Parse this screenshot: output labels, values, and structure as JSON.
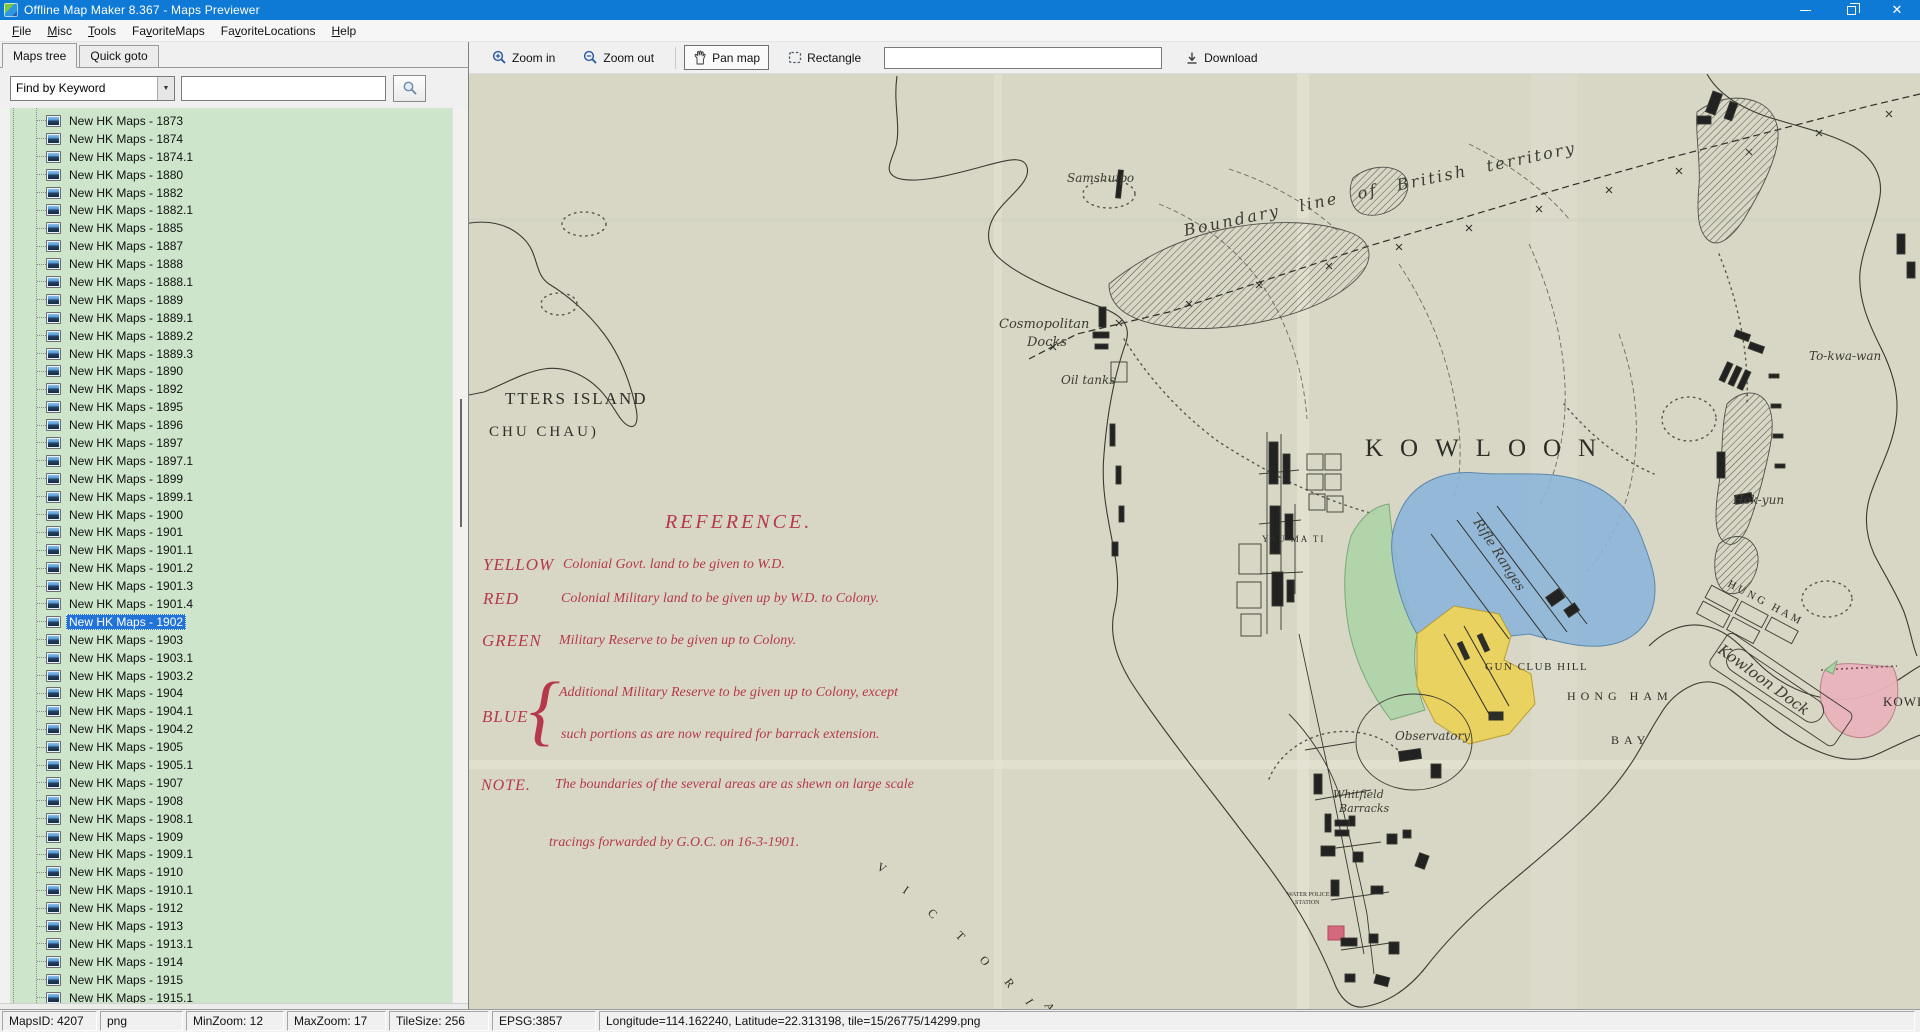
{
  "window": {
    "title": "Offline Map Maker 8.367 - Maps Previewer"
  },
  "menu": {
    "items": [
      {
        "label": "File",
        "accel": 0
      },
      {
        "label": "Misc",
        "accel": 0
      },
      {
        "label": "Tools",
        "accel": 0
      },
      {
        "label": "FavoriteMaps",
        "accel": 2
      },
      {
        "label": "FavoriteLocations",
        "accel": 2
      },
      {
        "label": "Help",
        "accel": 0
      }
    ]
  },
  "left_panel": {
    "tabs": [
      {
        "label": "Maps tree"
      },
      {
        "label": "Quick goto"
      }
    ],
    "search": {
      "combo_value": "Find by Keyword",
      "query_value": ""
    },
    "tree": {
      "selected_index": 28,
      "items": [
        "New HK Maps - 1873",
        "New HK Maps - 1874",
        "New HK Maps - 1874.1",
        "New HK Maps - 1880",
        "New HK Maps - 1882",
        "New HK Maps - 1882.1",
        "New HK Maps - 1885",
        "New HK Maps - 1887",
        "New HK Maps - 1888",
        "New HK Maps - 1888.1",
        "New HK Maps - 1889",
        "New HK Maps - 1889.1",
        "New HK Maps - 1889.2",
        "New HK Maps - 1889.3",
        "New HK Maps - 1890",
        "New HK Maps - 1892",
        "New HK Maps - 1895",
        "New HK Maps - 1896",
        "New HK Maps - 1897",
        "New HK Maps - 1897.1",
        "New HK Maps - 1899",
        "New HK Maps - 1899.1",
        "New HK Maps - 1900",
        "New HK Maps - 1901",
        "New HK Maps - 1901.1",
        "New HK Maps - 1901.2",
        "New HK Maps - 1901.3",
        "New HK Maps - 1901.4",
        "New HK Maps - 1902",
        "New HK Maps - 1903",
        "New HK Maps - 1903.1",
        "New HK Maps - 1903.2",
        "New HK Maps - 1904",
        "New HK Maps - 1904.1",
        "New HK Maps - 1904.2",
        "New HK Maps - 1905",
        "New HK Maps - 1905.1",
        "New HK Maps - 1907",
        "New HK Maps - 1908",
        "New HK Maps - 1908.1",
        "New HK Maps - 1909",
        "New HK Maps - 1909.1",
        "New HK Maps - 1910",
        "New HK Maps - 1910.1",
        "New HK Maps - 1912",
        "New HK Maps - 1913",
        "New HK Maps - 1913.1",
        "New HK Maps - 1914",
        "New HK Maps - 1915",
        "New HK Maps - 1915.1"
      ]
    }
  },
  "map_toolbar": {
    "buttons": [
      {
        "label": "Zoom in"
      },
      {
        "label": "Zoom out"
      },
      {
        "label": "Pan map"
      },
      {
        "label": "Rectangle"
      }
    ],
    "input_value": "",
    "download_label": "Download"
  },
  "status_bar": {
    "panels": [
      "MapsID: 4207",
      "png",
      "MinZoom: 12",
      "MaxZoom: 17",
      "TileSize: 256",
      "EPSG:3857",
      "Longitude=114.162240, Latitude=22.313198, tile=15/26775/14299.png"
    ]
  },
  "map_view": {
    "colors": {
      "paper": "#d8d7c5",
      "blue": "#8db6d9",
      "green": "#abd3a6",
      "yellow": "#ebd158",
      "pink": "#e9b3bd",
      "red_area": "#d4687c",
      "red_ink": "#b5394b",
      "ink": "#3a3a32"
    },
    "labels": [
      {
        "t": "TTERS ISLAND",
        "x": 36,
        "y": 330,
        "s": 17,
        "c": "print",
        "ls": 2
      },
      {
        "t": "CHU CHAU)",
        "x": 20,
        "y": 362,
        "s": 15,
        "c": "print",
        "ls": 3
      },
      {
        "t": "Samshuipo",
        "x": 598,
        "y": 108,
        "s": 12,
        "c": "script"
      },
      {
        "t": "Cosmopolitan",
        "x": 530,
        "y": 254,
        "s": 13,
        "c": "script"
      },
      {
        "t": "Docks",
        "x": 558,
        "y": 272,
        "s": 13,
        "c": "script"
      },
      {
        "t": "Oil tanks",
        "x": 592,
        "y": 310,
        "s": 12,
        "c": "script"
      },
      {
        "t": "Boundary line of British territory",
        "x": 716,
        "y": 162,
        "s": 16,
        "c": "script",
        "r": -12,
        "ls": 2.5,
        "ws": 12
      },
      {
        "t": "KOWLOON",
        "x": 896,
        "y": 382,
        "s": 25,
        "c": "print",
        "ls": 17
      },
      {
        "t": "YAU MA TI",
        "x": 793,
        "y": 468,
        "s": 9,
        "c": "print",
        "ls": 2
      },
      {
        "t": "Rifle Ranges",
        "x": 1004,
        "y": 448,
        "s": 13,
        "c": "script",
        "r": 57
      },
      {
        "t": "GUN CLUB HILL",
        "x": 1016,
        "y": 596,
        "s": 11,
        "c": "print",
        "ls": 1.5
      },
      {
        "t": "HONG HAM",
        "x": 1098,
        "y": 626,
        "s": 12,
        "c": "print",
        "ls": 5
      },
      {
        "t": "BAY",
        "x": 1142,
        "y": 670,
        "s": 12,
        "c": "print",
        "ls": 5
      },
      {
        "t": "Observatory",
        "x": 926,
        "y": 666,
        "s": 12,
        "c": "script"
      },
      {
        "t": "Whitfield",
        "x": 864,
        "y": 724,
        "s": 11,
        "c": "script"
      },
      {
        "t": "Barracks",
        "x": 870,
        "y": 738,
        "s": 11,
        "c": "script"
      },
      {
        "t": "WATER POLICE",
        "x": 818,
        "y": 822,
        "s": 6,
        "c": "print"
      },
      {
        "t": "STATION",
        "x": 826,
        "y": 830,
        "s": 6,
        "c": "print"
      },
      {
        "t": "Kowloon Dock",
        "x": 1248,
        "y": 578,
        "s": 15,
        "c": "script",
        "r": 36
      },
      {
        "t": "HUNG HAM",
        "x": 1258,
        "y": 512,
        "s": 11,
        "c": "print",
        "ls": 3,
        "r": 28
      },
      {
        "t": "To-kwa-wan",
        "x": 1340,
        "y": 286,
        "s": 12,
        "c": "script"
      },
      {
        "t": "Hok-yun",
        "x": 1264,
        "y": 430,
        "s": 12,
        "c": "script"
      },
      {
        "t": "KOWL",
        "x": 1414,
        "y": 632,
        "s": 13,
        "c": "print",
        "ls": 1
      },
      {
        "t": "V",
        "x": 407,
        "y": 795,
        "s": 12,
        "c": "print",
        "r": 30
      },
      {
        "t": "I",
        "x": 433,
        "y": 818,
        "s": 12,
        "c": "print",
        "r": 34
      },
      {
        "t": "C",
        "x": 458,
        "y": 840,
        "s": 12,
        "c": "print",
        "r": 40
      },
      {
        "t": "T",
        "x": 486,
        "y": 862,
        "s": 12,
        "c": "print",
        "r": 46
      },
      {
        "t": "O",
        "x": 510,
        "y": 886,
        "s": 12,
        "c": "print",
        "r": 50
      },
      {
        "t": "R",
        "x": 535,
        "y": 908,
        "s": 12,
        "c": "print",
        "r": 54
      },
      {
        "t": "I",
        "x": 556,
        "y": 928,
        "s": 12,
        "c": "print",
        "r": 58
      },
      {
        "t": "A",
        "x": 575,
        "y": 931,
        "s": 12,
        "c": "print",
        "r": 62
      },
      {
        "t": "REFERENCE.",
        "x": 196,
        "y": 454,
        "s": 20,
        "c": "red",
        "ls": 3
      },
      {
        "t": "YELLOW",
        "x": 14,
        "y": 496,
        "s": 17,
        "c": "red",
        "ls": 1
      },
      {
        "t": "Colonial Govt. land to be given to W.D.",
        "x": 94,
        "y": 494,
        "s": 14,
        "c": "red"
      },
      {
        "t": "RED",
        "x": 14,
        "y": 530,
        "s": 17,
        "c": "red",
        "ls": 1
      },
      {
        "t": "Colonial Military land to be given up by W.D. to Colony.",
        "x": 92,
        "y": 528,
        "s": 14,
        "c": "red"
      },
      {
        "t": "GREEN",
        "x": 13,
        "y": 572,
        "s": 17,
        "c": "red",
        "ls": 1
      },
      {
        "t": "Military Reserve to be given up to Colony.",
        "x": 90,
        "y": 570,
        "s": 14,
        "c": "red"
      },
      {
        "t": "BLUE",
        "x": 13,
        "y": 648,
        "s": 17,
        "c": "red",
        "ls": 1
      },
      {
        "t": "{",
        "x": 60,
        "y": 662,
        "s": 78,
        "c": "red"
      },
      {
        "t": "Additional Military Reserve to be given up to Colony, except",
        "x": 90,
        "y": 622,
        "s": 14,
        "c": "red"
      },
      {
        "t": "such portions as are now required for barrack extension.",
        "x": 92,
        "y": 664,
        "s": 14,
        "c": "red"
      },
      {
        "t": "NOTE.",
        "x": 12,
        "y": 716,
        "s": 16,
        "c": "red",
        "ls": 1
      },
      {
        "t": "The boundaries of the several areas are as shewn on large scale",
        "x": 86,
        "y": 714,
        "s": 14,
        "c": "red"
      },
      {
        "t": "tracings forwarded by G.O.C. on 16-3-1901.",
        "x": 80,
        "y": 772,
        "s": 14,
        "c": "red"
      }
    ]
  }
}
